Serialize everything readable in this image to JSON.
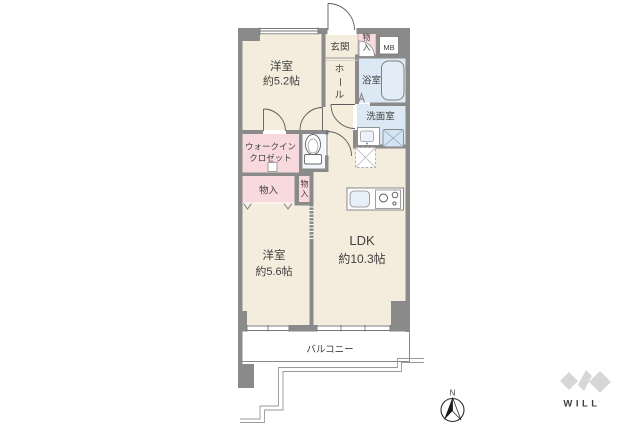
{
  "rooms": {
    "western_room_1": {
      "name": "洋室",
      "size": "約5.2帖"
    },
    "western_room_2": {
      "name": "洋室",
      "size": "約5.6帖"
    },
    "ldk": {
      "name": "LDK",
      "size": "約10.3帖"
    },
    "entrance": {
      "name": "玄関"
    },
    "hall": {
      "char1": "ホ",
      "char2": "ー",
      "char3": "ル"
    },
    "bathroom": {
      "name": "浴室"
    },
    "washroom": {
      "name": "洗面室"
    },
    "walk_in_closet": {
      "line1": "ウォークイン",
      "line2": "クロゼット"
    },
    "storage_entrance": {
      "char1": "物",
      "char2": "入"
    },
    "storage_hall": {
      "name": "物入"
    },
    "storage_narrow": {
      "char1": "物",
      "char2": "入"
    },
    "meter_box": {
      "label": "MB"
    },
    "balcony": {
      "name": "バルコニー"
    }
  },
  "compass": {
    "north_label": "N"
  },
  "brand": {
    "logo_text": "WILL"
  },
  "colors": {
    "wall": "#8A8A8A",
    "room_cream": "#F4EDDE",
    "room_pink": "#F8D9DE",
    "room_blue": "#DCE9F5",
    "label_text": "#3F3F3F",
    "logo_gray": "#CFCFCF"
  }
}
